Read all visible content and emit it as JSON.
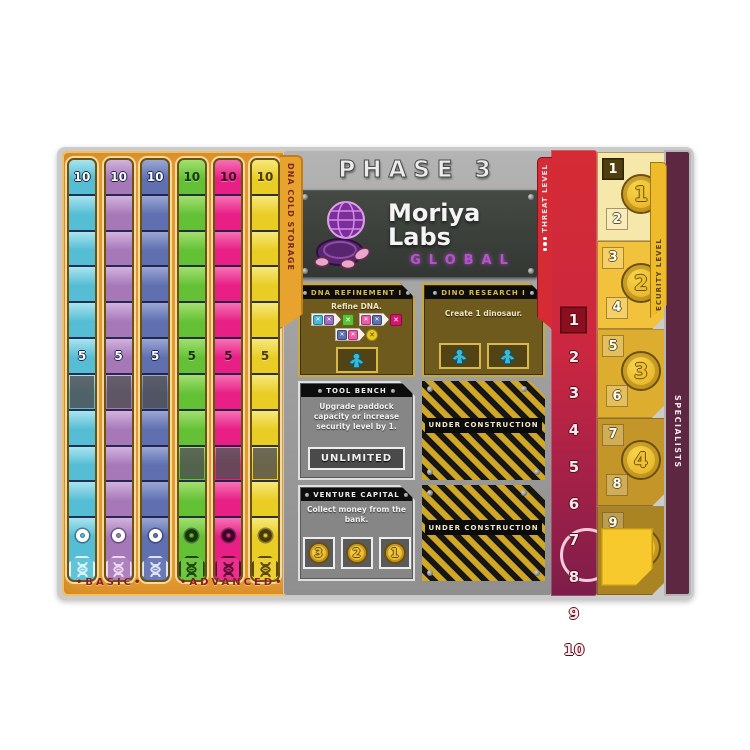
{
  "header": {
    "phase_title": "PHASE 3",
    "company_name": "Moriya Labs",
    "company_subtitle": "GLOBAL"
  },
  "dna_storage": {
    "tab_label": "DNA COLD STORAGE",
    "basic_label": "•BASIC•",
    "advanced_label": "•ADVANCED•",
    "cell_values": [
      10,
      9,
      8,
      7,
      6,
      5,
      4,
      3,
      2,
      1,
      0
    ],
    "labeled_values": [
      10,
      5
    ],
    "tracks": [
      {
        "id": "cyan",
        "group": "basic",
        "color": "#55bdd4",
        "light": "#a8e4ef",
        "num_style": "light",
        "num_color": "#ffffff",
        "badge_color": "#d6f4fa",
        "grayed_value": 4
      },
      {
        "id": "purple",
        "group": "basic",
        "color": "#a678b8",
        "light": "#d2b2de",
        "num_style": "light",
        "num_color": "#ffffff",
        "badge_color": "#ecd6f4",
        "grayed_value": 4
      },
      {
        "id": "blue",
        "group": "basic",
        "color": "#5f6fb0",
        "light": "#9aa6d4",
        "num_style": "light",
        "num_color": "#ffffff",
        "badge_color": "#dde2f6",
        "grayed_value": 4
      },
      {
        "id": "green",
        "group": "advanced",
        "color": "#64c136",
        "light": "#a2e070",
        "num_style": "dark",
        "num_color": "#173608",
        "badge_color": "#1d4a0c",
        "grayed_value": 2
      },
      {
        "id": "magenta",
        "group": "advanced",
        "color": "#e81f85",
        "light": "#f671b4",
        "num_style": "dark",
        "num_color": "#3d0723",
        "badge_color": "#5c0b33",
        "grayed_value": 2
      },
      {
        "id": "yellow",
        "group": "advanced",
        "color": "#e9cd25",
        "light": "#f7e87a",
        "num_style": "dark",
        "num_color": "#4a3a05",
        "badge_color": "#5c4a06",
        "grayed_value": 2
      }
    ]
  },
  "action_panels": {
    "dna_refinement": {
      "title": "DNA REFINEMENT I",
      "text": "Refine DNA.",
      "recipes": [
        {
          "inputs": [
            "#49b8d8",
            "#9a6ec0"
          ],
          "output": "#5cc132",
          "round": false
        },
        {
          "inputs": [
            "#f05aaa",
            "#5f6fb0"
          ],
          "output": "#d4156e",
          "round": false
        },
        {
          "inputs": [
            "#5f6fb0",
            "#f05aaa"
          ],
          "output": "#ecc91f",
          "round": true
        }
      ],
      "worker_slots": 1
    },
    "dino_research": {
      "title": "DINO RESEARCH I",
      "text": "Create 1 dinosaur.",
      "worker_slots": 2
    },
    "tool_bench": {
      "title": "TOOL BENCH",
      "text": "Upgrade paddock capacity or increase security level by 1.",
      "slot_label": "UNLIMITED"
    },
    "venture_capital": {
      "title": "VENTURE CAPITAL",
      "text": "Collect money from the bank.",
      "coin_values": [
        3,
        2,
        1
      ]
    },
    "under_construction": {
      "label": "UNDER CONSTRUCTION"
    }
  },
  "threat_track": {
    "tab_label": "THREAT LEVEL",
    "levels": [
      1,
      2,
      3,
      4,
      5,
      6,
      7,
      8,
      9,
      10
    ],
    "current_level": 1
  },
  "security_track": {
    "tab_label": "SECURITY LEVEL",
    "current_level": 1,
    "groups": [
      {
        "levels": [
          1,
          2
        ],
        "coin": 1,
        "bg": "#f6e7ab"
      },
      {
        "levels": [
          3,
          4
        ],
        "coin": 2,
        "bg": "#f3c23d"
      },
      {
        "levels": [
          5,
          6
        ],
        "coin": 3,
        "bg": "#ddad30"
      },
      {
        "levels": [
          7,
          8
        ],
        "coin": 4,
        "bg": "#c49629"
      },
      {
        "levels": [
          9,
          10
        ],
        "coin": 5,
        "bg": "#aa8322"
      }
    ]
  },
  "specialists": {
    "label": "SPECIALISTS"
  },
  "colors": {
    "board_orange": "#e4992f",
    "metal_gray": "#a2a2a2",
    "threat_red": "#d42b35",
    "threat_maroon": "#7d1d4a",
    "gold_panel": "#6e5a1c",
    "brand_purple": "#bb4fd4",
    "coin_gold": "#eebc2a",
    "specialists_maroon": "#5d2641",
    "worker_cyan": "#38b8d6"
  }
}
